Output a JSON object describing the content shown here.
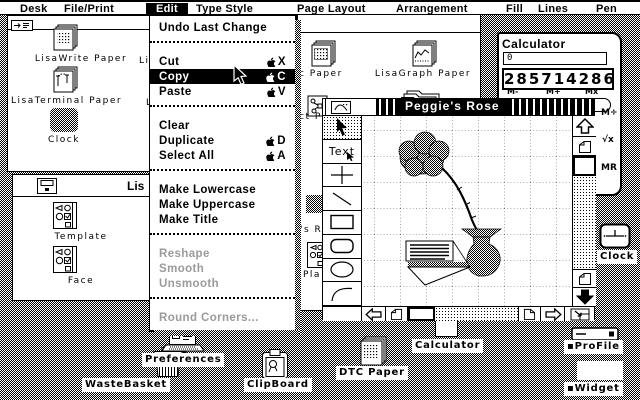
{
  "menu_bar": {
    "items": [
      {
        "label": "Desk"
      },
      {
        "label": "File/Print"
      },
      {
        "label": "Edit",
        "active": true
      },
      {
        "label": "Type Style"
      },
      {
        "label": "Page Layout"
      },
      {
        "label": "Arrangement"
      },
      {
        "label": "Fill"
      },
      {
        "label": "Lines"
      },
      {
        "label": "Pen"
      }
    ]
  },
  "edit_menu": {
    "items": [
      {
        "label": "Undo Last Change"
      },
      {
        "separator": true
      },
      {
        "label": "Cut",
        "shortcut": "X"
      },
      {
        "label": "Copy",
        "shortcut": "C",
        "highlighted": true
      },
      {
        "label": "Paste",
        "shortcut": "V"
      },
      {
        "separator": true
      },
      {
        "label": "Clear"
      },
      {
        "label": "Duplicate",
        "shortcut": "D"
      },
      {
        "label": "Select All",
        "shortcut": "A"
      },
      {
        "separator": true
      },
      {
        "label": "Make Lowercase"
      },
      {
        "label": "Make Uppercase"
      },
      {
        "label": "Make Title"
      },
      {
        "separator": true
      },
      {
        "label": "Reshape",
        "disabled": true
      },
      {
        "label": "Smooth",
        "disabled": true
      },
      {
        "label": "Unsmooth",
        "disabled": true
      },
      {
        "separator": true
      },
      {
        "label": "Round Corners...",
        "disabled": true
      }
    ]
  },
  "window_documents": {
    "icons": [
      {
        "label": "LisaWrite Paper"
      },
      {
        "label": "LisaTerminal Paper"
      },
      {
        "label": "Clock"
      }
    ],
    "clipped_labels": [
      "Li",
      "L"
    ]
  },
  "window_stationery": {
    "title": "Lis",
    "icons": [
      {
        "label": "Template"
      },
      {
        "label": "Face"
      }
    ]
  },
  "window_background": {
    "icons": [
      {
        "label": "c Paper"
      },
      {
        "label": "LisaGraph Paper"
      }
    ],
    "clipped_labels": [
      "ct P",
      "'s R",
      "Pla"
    ]
  },
  "drawing_window": {
    "title": "Peggie's Rose",
    "tools": {
      "text_label": "Text"
    }
  },
  "calculator": {
    "title": "Calculator",
    "memory_display": "0",
    "main_display": "285714286",
    "button_labels": [
      "M-",
      "M+",
      "Mx",
      "M÷",
      "√x",
      "MR"
    ]
  },
  "desktop_icons": [
    {
      "label": "WasteBasket"
    },
    {
      "label": "Preferences"
    },
    {
      "label": "ClipBoard"
    },
    {
      "label": "DTC Paper"
    },
    {
      "label": "Calculator"
    },
    {
      "label": "Clock"
    },
    {
      "label": "▪ProFile"
    },
    {
      "label": "▪Widget"
    }
  ]
}
